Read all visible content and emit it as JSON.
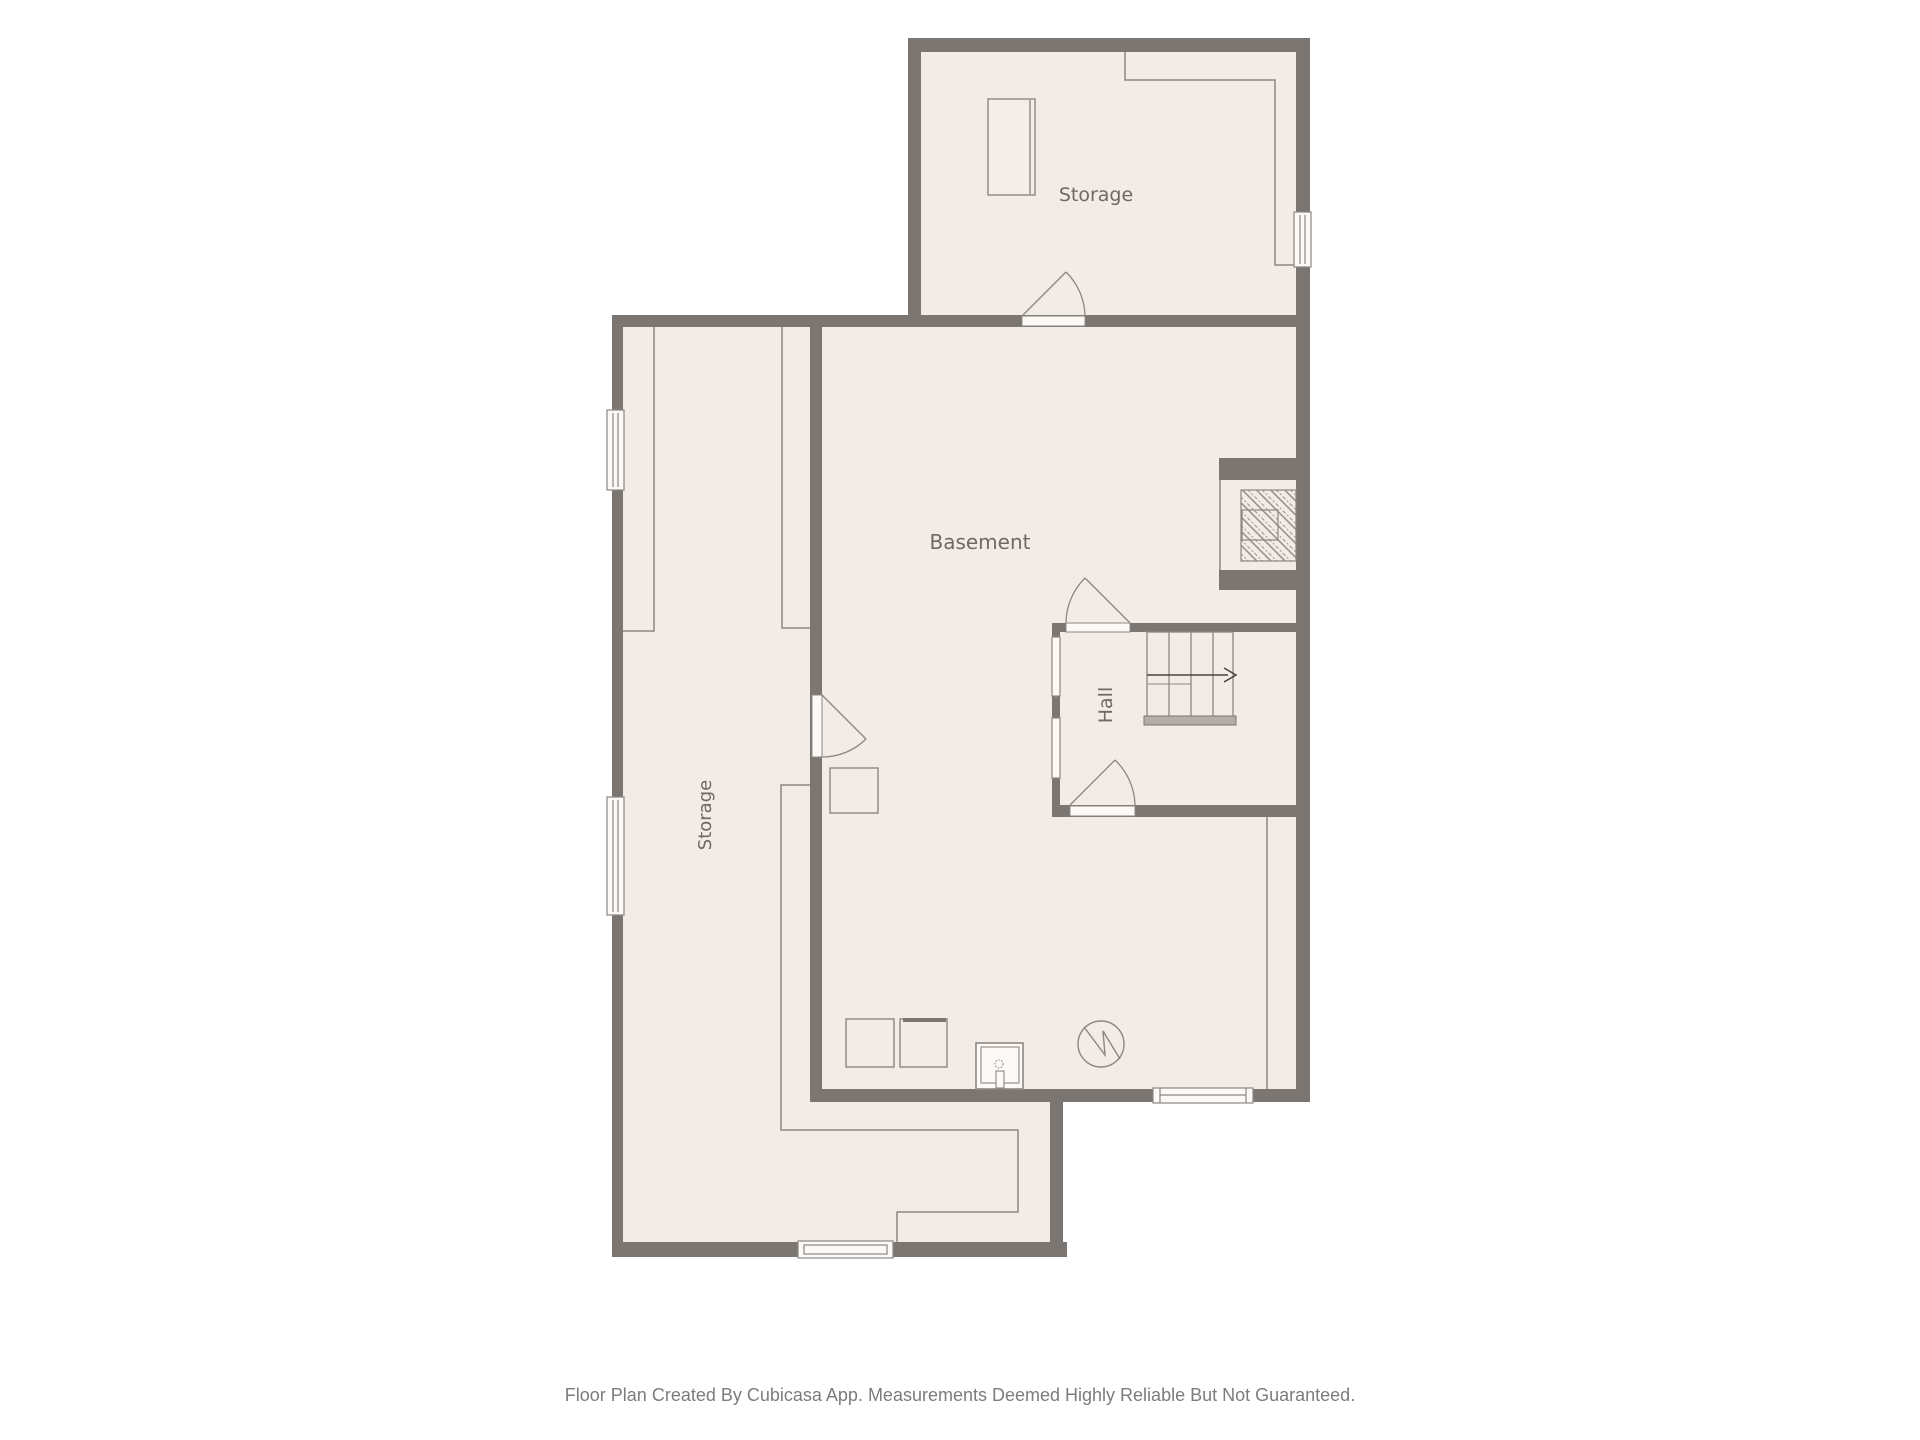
{
  "floorplan": {
    "rooms": {
      "storage_top": {
        "label": "Storage"
      },
      "basement": {
        "label": "Basement"
      },
      "hall": {
        "label": "Hall"
      },
      "storage_left": {
        "label": "Storage"
      }
    },
    "caption": "Floor Plan Created By Cubicasa App. Measurements Deemed Highly Reliable But Not Guaranteed.",
    "colors": {
      "background": "#ffffff",
      "wall": "#7b7672",
      "floor": "#f2ebe6",
      "thin_line": "#8d8782",
      "window_fill": "#fcf9f6",
      "label_text": "#6e6965",
      "caption_text": "#7c7c7c",
      "stair_arrow": "#45423f"
    }
  }
}
